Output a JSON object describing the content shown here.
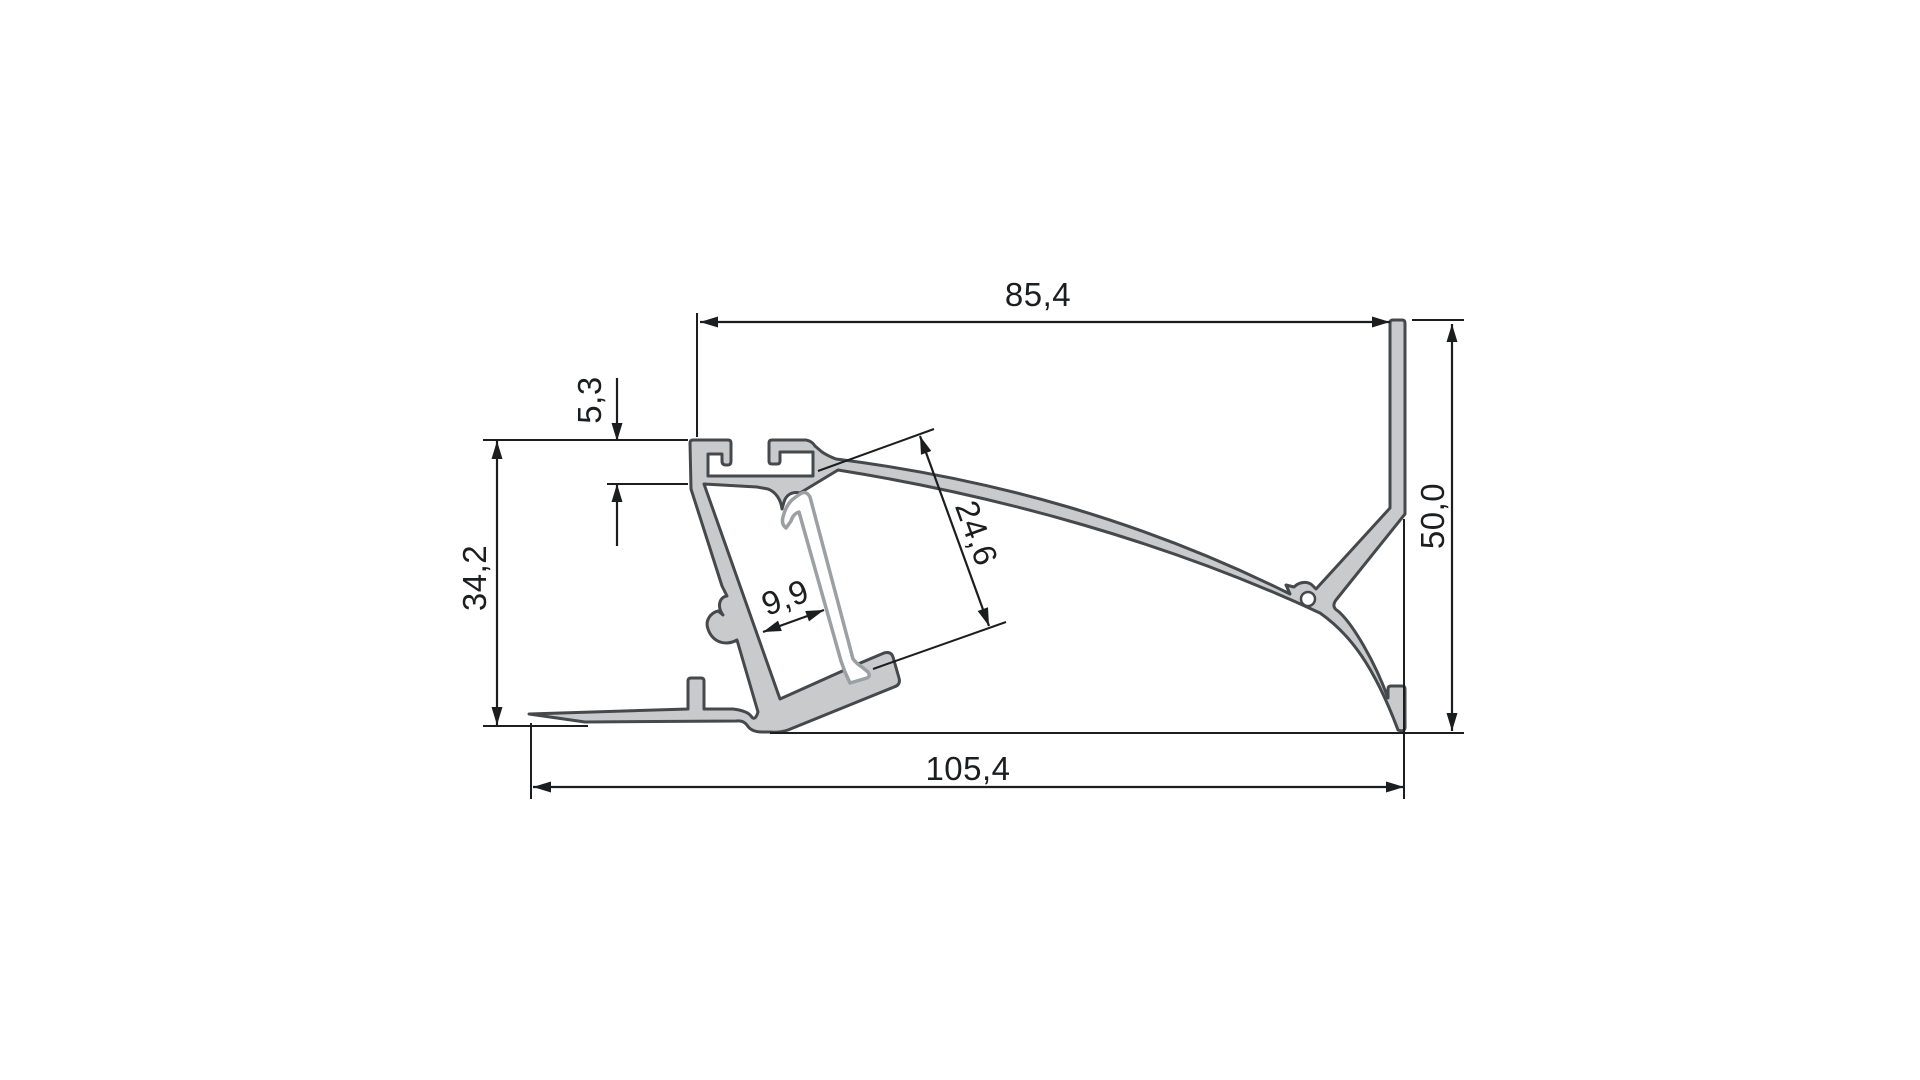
{
  "drawing": {
    "kind": "aluminium LED profile cross-section, dimensioned technical drawing",
    "dimensions": {
      "top_width": "85,4",
      "lip_height": "5,3",
      "left_height": "34,2",
      "channel_depth": "24,6",
      "channel_inner_width": "9,9",
      "right_height": "50,0",
      "bottom_width": "105,4"
    },
    "colors": {
      "background": "#ffffff",
      "profile_fill": "#c8cacb",
      "profile_outline": "#46494c",
      "cover_fill": "#ffffff",
      "cover_outline": "#9ba0a3",
      "dimension": "#1b1d1f"
    }
  }
}
